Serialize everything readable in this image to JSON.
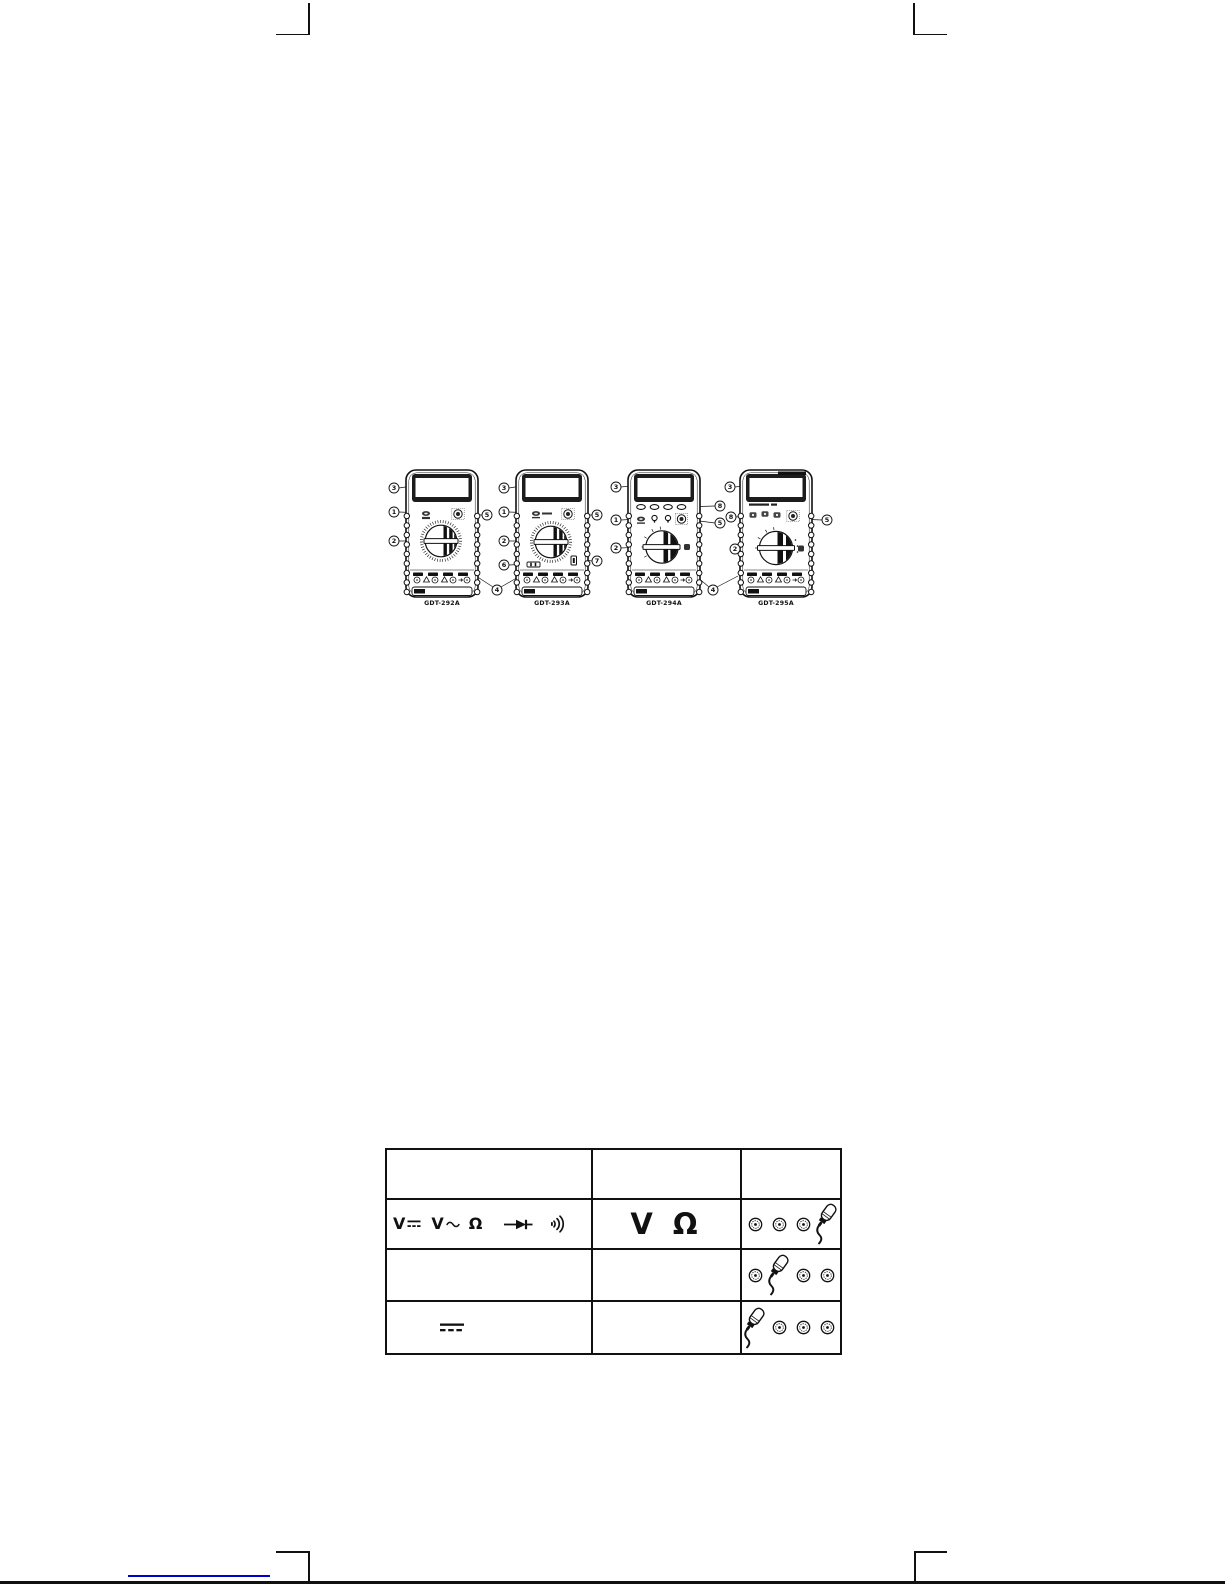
{
  "figure": {
    "meters": [
      {
        "model": "GDT-292A",
        "callouts": [
          "3",
          "1",
          "5",
          "2"
        ]
      },
      {
        "model": "GDT-293A",
        "callouts": [
          "3",
          "1",
          "5",
          "2",
          "6",
          "7"
        ]
      },
      {
        "model": "GDT-294A",
        "callouts": [
          "3",
          "8",
          "1",
          "5",
          "2"
        ]
      },
      {
        "model": "GDT-295A",
        "callouts": [
          "3",
          "8",
          "5",
          "2"
        ]
      }
    ],
    "shared_callouts": [
      "4",
      "4"
    ]
  },
  "table": {
    "columns": [
      "",
      "",
      ""
    ],
    "rows": [
      {
        "functions": [
          {
            "text": "V",
            "icon": "dc"
          },
          {
            "text": "V",
            "icon": "ac"
          },
          {
            "text": "Ω"
          },
          {
            "icon": "diode"
          },
          {
            "icon": "continuity"
          }
        ],
        "display": "V Ω",
        "jack_count": 4,
        "probe_position": 4
      },
      {
        "functions": [],
        "display": "",
        "jack_count": 4,
        "probe_position": 2
      },
      {
        "functions": [
          {
            "icon": "dc-large"
          }
        ],
        "display": "",
        "jack_count": 4,
        "probe_position": 1
      }
    ]
  },
  "footer": {
    "link_underline_color": "#0000cc"
  }
}
